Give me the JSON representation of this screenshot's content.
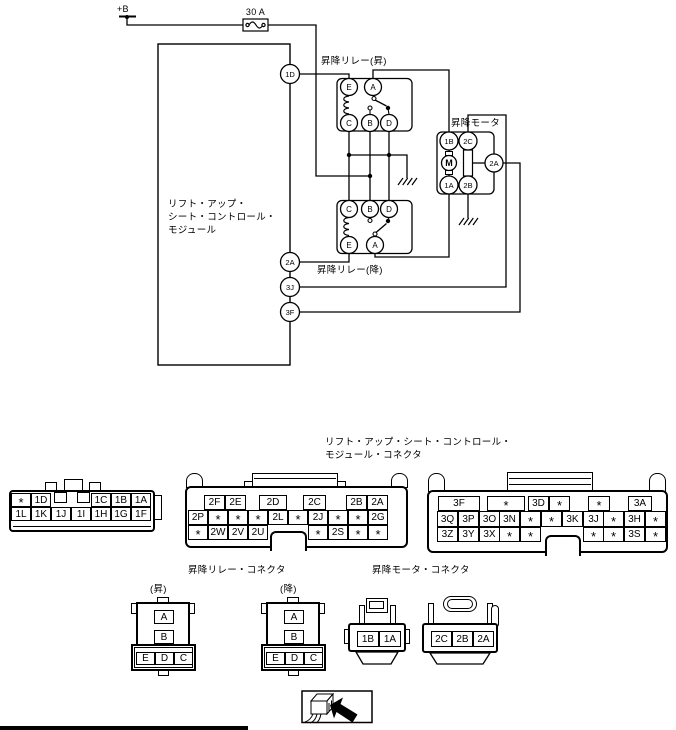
{
  "labels": {
    "power": "+B",
    "fuse": "30 A",
    "module_line1": "リフト・アップ・",
    "module_line2": "シート・コントロール・",
    "module_line3": "モジュール",
    "relay_up": "昇降リレー(昇)",
    "relay_down": "昇降リレー(降)",
    "motor": "昇降モータ",
    "module_connector_line1": "リフト・アップ・シート・コントロール・",
    "module_connector_line2": "モジュール・コネクタ",
    "relay_connector": "昇降リレー・コネクタ",
    "relay_up_tag": "(昇)",
    "relay_down_tag": "(降)",
    "motor_connector": "昇降モータ・コネクタ"
  },
  "circuit": {
    "module_pins": [
      "1D",
      "2A",
      "3J",
      "3F"
    ],
    "relay_up_pins": {
      "e": "E",
      "a": "A",
      "c": "C",
      "b": "B",
      "d": "D"
    },
    "relay_down_pins": {
      "c": "C",
      "b": "B",
      "d": "D",
      "e": "E",
      "a": "A"
    },
    "motor_pins": {
      "b1": "1B",
      "c2": "2C",
      "m": "M",
      "a2": "2A",
      "a1": "1A",
      "b2": "2B"
    }
  },
  "connectors": {
    "c1": {
      "row0": [
        "*",
        "1D",
        "1C",
        "1B",
        "1A"
      ],
      "row1": [
        "1L",
        "1K",
        "1J",
        "1I",
        "1H",
        "1G",
        "1F"
      ]
    },
    "c2": {
      "row0": [
        "2F",
        "2E",
        "2D",
        "2C",
        "2B",
        "2A"
      ],
      "row1": [
        "2P",
        "*",
        "*",
        "*",
        "2L",
        "*",
        "2J",
        "*",
        "*",
        "2G"
      ],
      "row2": [
        "*",
        "2W",
        "2V",
        "2U",
        "*",
        "2S",
        "*",
        "*"
      ]
    },
    "c3": {
      "row0": [
        "3F",
        "*",
        "3D",
        "*",
        "*",
        "3A"
      ],
      "row1": [
        "3Q",
        "3P",
        "3O",
        "3N",
        "*",
        "*",
        "3K",
        "3J",
        "*",
        "3H",
        "*"
      ],
      "row2": [
        "3Z",
        "3Y",
        "3X",
        "*",
        "*",
        "*",
        "*",
        "3S",
        "*"
      ]
    },
    "relay": {
      "a": "A",
      "b": "B",
      "e": "E",
      "d": "D",
      "c": "C"
    },
    "motor1": [
      "1B",
      "1A"
    ],
    "motor2": [
      "2C",
      "2B",
      "2A"
    ]
  }
}
